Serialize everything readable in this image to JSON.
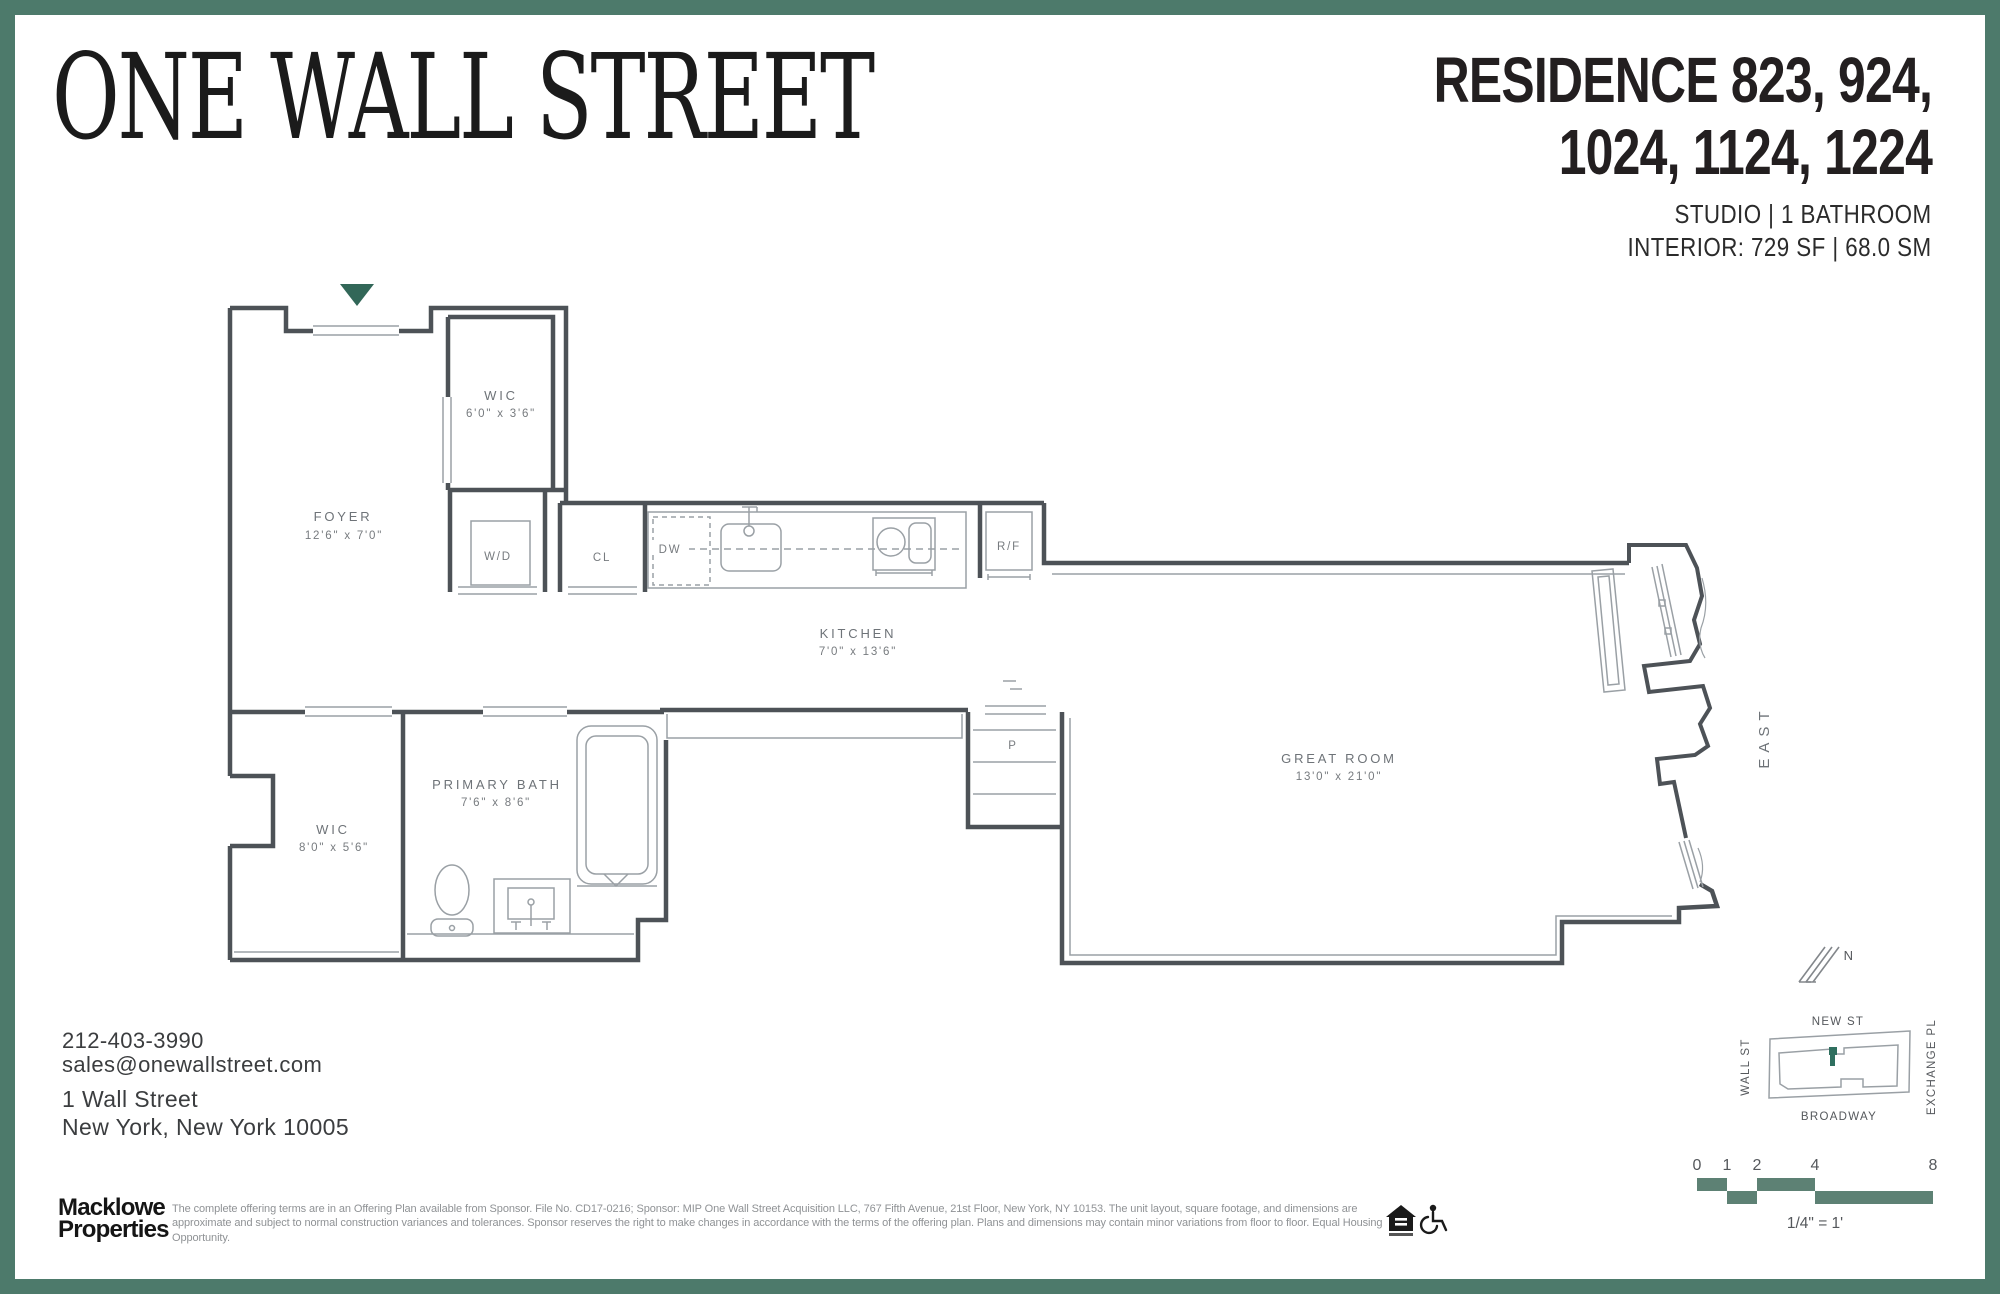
{
  "colors": {
    "border_green": "#4d7a6b",
    "scalebar_green": "#5d8174",
    "marker_green": "#2f6f5f",
    "triangle_green": "#326758",
    "wall_gray": "#4d5257",
    "fixture_gray": "#9aa0a5",
    "label_gray": "#6e7378"
  },
  "header": {
    "logo": "ONE WALL STREET",
    "residence_line1": "RESIDENCE 823, 924,",
    "residence_line2": "1024, 1124, 1224",
    "specs_line1": "STUDIO  |  1 BATHROOM",
    "specs_line2": "INTERIOR: 729 SF  |  68.0 SM"
  },
  "plan": {
    "foyer": {
      "name": "FOYER",
      "dims": "12'6\" x 7'0\""
    },
    "wic_upper": {
      "name": "WIC",
      "dims": "6'0\" x 3'6\""
    },
    "wd": {
      "name": "W/D"
    },
    "cl": {
      "name": "CL"
    },
    "dw": {
      "name": "DW"
    },
    "kitchen": {
      "name": "KITCHEN",
      "dims": "7'0\" x 13'6\""
    },
    "rf": {
      "name": "R/F"
    },
    "wic_lower": {
      "name": "WIC",
      "dims": "8'0\" x 5'6\""
    },
    "primary_bath": {
      "name": "PRIMARY BATH",
      "dims": "7'6\" x 8'6\""
    },
    "pantry": {
      "name": "P"
    },
    "great_room": {
      "name": "GREAT ROOM",
      "dims": "13'0\" x 21'0\""
    },
    "east_label": "EAST",
    "north_label": "N"
  },
  "contact": {
    "phone": "212-403-3990",
    "email": "sales@onewallstreet.com",
    "address_line1": "1 Wall Street",
    "address_line2": "New York, New York 10005"
  },
  "map": {
    "street_top": "NEW ST",
    "street_left": "WALL ST",
    "street_bottom": "BROADWAY",
    "street_right": "EXCHANGE PL"
  },
  "scale": {
    "ticks": [
      "0",
      "1",
      "2",
      "4",
      "8"
    ],
    "ratio": "1/4\" = 1'"
  },
  "footer": {
    "brand_line1": "Macklowe",
    "brand_line2": "Properties",
    "disclaimer_line1": "The complete offering terms are in an Offering Plan available from Sponsor. File No. CD17-0216; Sponsor: MIP One Wall Street Acquisition LLC, 767 Fifth Avenue, 21st Floor, New York, NY 10153. The unit layout, square footage, and dimensions are approximate",
    "disclaimer_line2": "and subject to normal construction variances and tolerances. Sponsor reserves the right to make changes in accordance with the terms of the offering plan. Plans and dimensions may contain minor variations from floor to floor. Equal Housing Opportunity."
  }
}
